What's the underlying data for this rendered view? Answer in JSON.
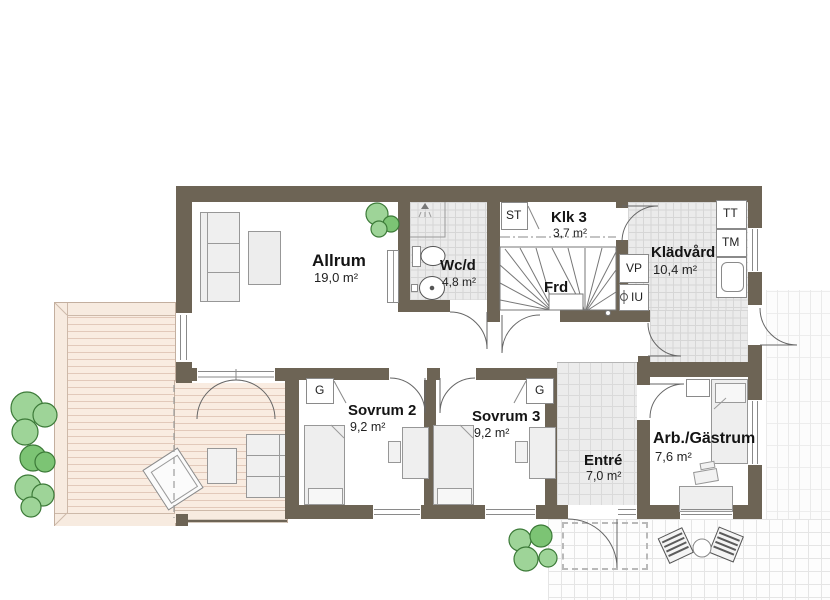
{
  "rooms": {
    "allrum": {
      "name": "Allrum",
      "area": "19,0 m²"
    },
    "wcd": {
      "name": "Wc/d",
      "area": "4,8 m²"
    },
    "klk3": {
      "name": "Klk 3",
      "area": "3,7 m²"
    },
    "frd": {
      "name": "Frd",
      "area": ""
    },
    "kladvard": {
      "name": "Klädvård",
      "area": "10,4 m²"
    },
    "sovrum2": {
      "name": "Sovrum 2",
      "area": "9,2 m²"
    },
    "sovrum3": {
      "name": "Sovrum 3",
      "area": "9,2 m²"
    },
    "entre": {
      "name": "Entré",
      "area": "7,0 m²"
    },
    "arbgastrum": {
      "name": "Arb./Gästrum",
      "area": "7,6 m²"
    }
  },
  "fixture_labels": {
    "st": "ST",
    "tt": "TT",
    "tm": "TM",
    "vp": "VP",
    "iu": "IU",
    "g_sovrum2": "G",
    "g_sovrum3": "G"
  },
  "colors": {
    "wall": "#6d6455",
    "tile_floor": "#ebebeb",
    "deck": "#f9ece1",
    "tree_fill": "#9ed498",
    "tree_dark": "#7cc474",
    "furniture": "#ededed",
    "paving_line": "#e5e5e5"
  }
}
